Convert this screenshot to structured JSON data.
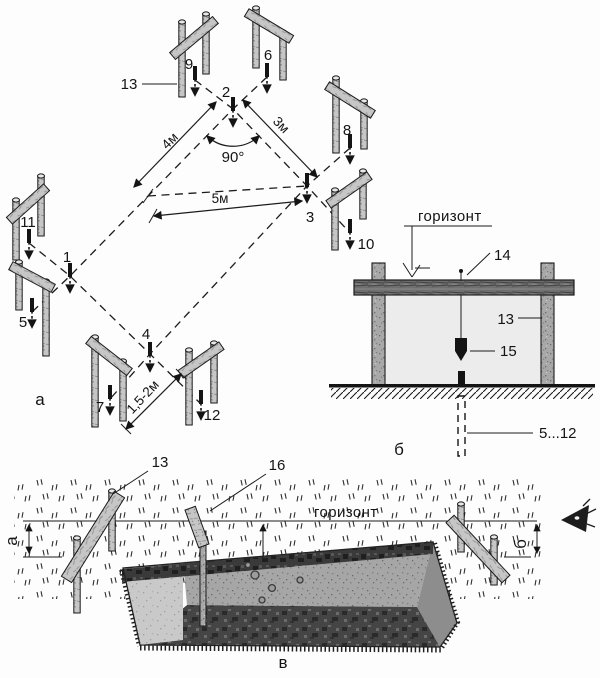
{
  "part_a": {
    "caption": "а",
    "corner_1": "1",
    "corner_2": "2",
    "corner_3": "3",
    "corner_4": "4",
    "peg_5": "5",
    "peg_6": "6",
    "peg_7": "7",
    "peg_8": "8",
    "peg_9": "9",
    "peg_10": "10",
    "peg_11": "11",
    "peg_12": "12",
    "batter_board": "13",
    "dim_side_left": "4м",
    "dim_side_right": "3м",
    "dim_diagonal": "5м",
    "angle": "90°",
    "dim_offset": "1,5-2м"
  },
  "part_b": {
    "caption": "б",
    "horizon": "горизонт",
    "nail": "14",
    "batter_board": "13",
    "plumb_bob": "15",
    "buried_stakes": "5...12"
  },
  "part_v": {
    "caption": "в",
    "batter_board": "13",
    "sight_rail": "16",
    "horizon": "горизонт",
    "dim_left": "а",
    "dim_right": "б"
  }
}
